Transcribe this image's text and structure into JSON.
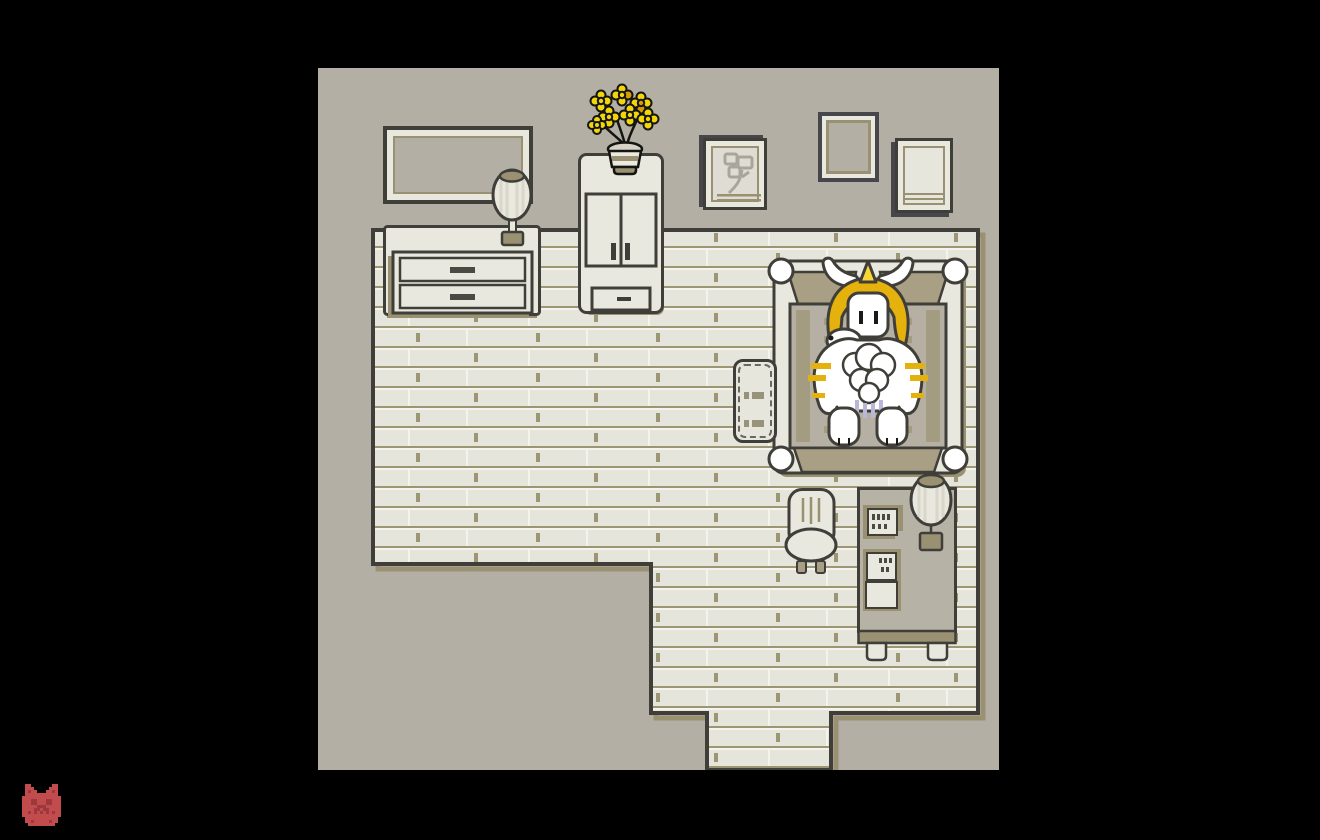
{
  "window": {
    "background": "#000000",
    "label": "game window showing a monochrome bedroom scene"
  },
  "colors": {
    "black": "#000000",
    "wall": "#b3afa5",
    "floor_base": "#e6e5db",
    "floor_hi": "#f4f4ec",
    "floor_line": "#9c9674",
    "outline": "#3f3e39",
    "cream": "#e9e8df",
    "cream_light": "#e7e6dc",
    "khaki": "#9a9173",
    "khaki_light": "#a89f84",
    "gray_furn": "#b7b2a6",
    "blanket": "#b5b0a3",
    "blanket_band": "#a49c80",
    "gold": "#e5b10d",
    "gold_light": "#f6d735",
    "yellow": "#f2d60b",
    "orange": "#d89b06",
    "lavender": "#b9b6d8",
    "sketch": "#a9a59b",
    "frame_shadow": "#47474b",
    "ink": "#4a4a44",
    "rug_mark": "#98927a",
    "red": "#c24b4d",
    "red_dark": "#9d393d"
  },
  "objects": {
    "room": "grey-and-cream pixel-art bedroom",
    "mirror": "wide wall mirror",
    "lamp_dresser": "striped table lamp on dresser",
    "dresser": "dresser with two drawers",
    "wardrobe": "tall wardrobe cabinet",
    "flowers": "vase of yellow flowers on wardrobe",
    "frame_sketch": "framed flower sketch",
    "frame_blank_middle": "empty picture frame",
    "frame_blank_right": "empty picture frame",
    "bed": "four-post double bed",
    "sleeper": "large white horned monster with golden mane sleeping on bed",
    "rug": "bedside rug",
    "chair": "wooden chair",
    "desk": "desk with papers and notes",
    "lamp_desk": "striped lamp on desk",
    "corridor": "doorway corridor at bottom of room",
    "taskbar_icon": "small red demon face pixel icon"
  },
  "sprites": {
    "demon_icon": {
      "cell": 3,
      "palette": {
        "R": "#c24b4d",
        "D": "#9d393d"
      },
      "grid": [
        ".RR.......RR.",
        ".RRR.....RRR.",
        ".RDRR...RRDR.",
        ".RRRRRRRRRRR.",
        "RRRRRRRRRRRRR",
        "RRRDDRRRDDRRR",
        "RRRDDRRRDDRRR",
        "RRRRRDDDRRRRR",
        "RRRRDDRDDRRRR",
        "RRDRDRDRDRDRR",
        "RRRRRRRRRRRRR",
        ".RRRRRRRRRRR.",
        ".RRDRRRRRDRR.",
        "..RRRRRRRRR.."
      ]
    }
  }
}
